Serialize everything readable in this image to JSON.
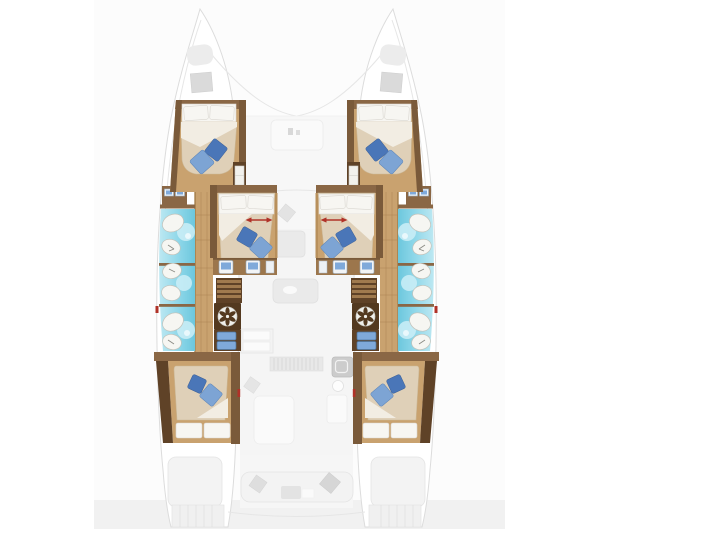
{
  "page": {
    "background": "#ffffff"
  },
  "image_panel": {
    "background": "#fcfcfc",
    "footer_strip": "#f1f1f1"
  },
  "colors": {
    "page_bg": "#ffffff",
    "panel_bg": "#fcfcfc",
    "footer_strip": "#f1f1f1",
    "wood": "#c9a26f",
    "wood_dark": "#9c764c",
    "trim": "#7a5a3a",
    "trim_light": "#8a6745",
    "trim_darker": "#5f4227",
    "mattress": "#dfd0b8",
    "linen": "#f7f6f2",
    "pillow_dark": "#4a76b8",
    "pillow_light": "#7da4d4",
    "bath_cyan": "#7fd2e6",
    "bath_cyan_light": "#c9edf5",
    "fixture": "#f6f6f2",
    "accent_red": "#b03228",
    "ghost": "#f3f3f3"
  },
  "plan": {
    "label": "catamaran deck plan, bow up",
    "hulls": [
      "port",
      "starboard"
    ],
    "cabins": [
      {
        "id": "forward-port",
        "type": "double-berth",
        "blue_pillows": 2
      },
      {
        "id": "mid-port",
        "type": "double-berth",
        "blue_pillows": 2,
        "dimension_arrow": true
      },
      {
        "id": "aft-port",
        "type": "double-berth",
        "blue_pillows": 2
      },
      {
        "id": "forward-starboard",
        "type": "double-berth",
        "blue_pillows": 2
      },
      {
        "id": "mid-starboard",
        "type": "double-berth",
        "blue_pillows": 2,
        "dimension_arrow": true
      },
      {
        "id": "aft-starboard",
        "type": "double-berth",
        "blue_pillows": 2
      }
    ],
    "bathrooms": [
      {
        "id": "port-heads",
        "fixtures": 6
      },
      {
        "id": "starboard-heads",
        "fixtures": 6
      }
    ],
    "equipment": [
      "bow-hatches",
      "companionway-stairs-port",
      "companionway-stairs-starboard",
      "washer-port",
      "washer-starboard",
      "vanity-sinks",
      "galley",
      "salon-table",
      "cockpit-bench",
      "swim-platforms"
    ]
  }
}
